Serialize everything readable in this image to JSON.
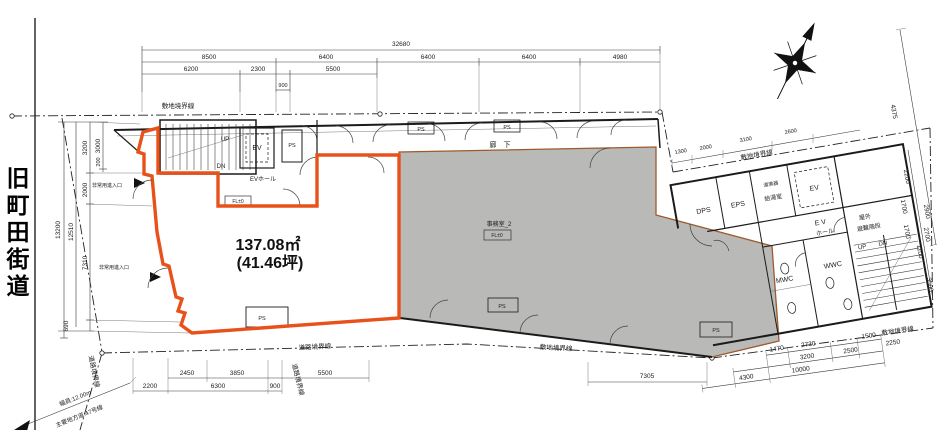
{
  "road": {
    "name": "旧町田街道",
    "width": "幅員:12.00m",
    "route": "主要地方道:47号線"
  },
  "area": {
    "size_sqm": "137.08㎡",
    "size_tsubo": "(41.46坪)"
  },
  "labels": {
    "site_boundary": "敷地境界線",
    "road_boundary": "道路境界線",
    "corridor": "廊　下",
    "emergency": "非常用進入口",
    "ev": "EV",
    "ev_sp": "E V",
    "hall": "ホール",
    "ev_hall": "EVホール",
    "ps": "PS",
    "dps": "DPS",
    "eps": "EPS",
    "kitchen": "給湯室",
    "water_heater": "湯沸器",
    "mwc": "MWC",
    "wwc": "WWC",
    "up": "UP",
    "dn": "DN",
    "outdoor": "屋外",
    "escape_stair": "避難階段",
    "office2": "事務室_2",
    "fl": "FL±0"
  },
  "dims": {
    "t32680": "32680",
    "t8500": "8500",
    "t6400": "6400",
    "t4980": "4980",
    "t6200": "6200",
    "t2300": "2300",
    "t5500": "5500",
    "t900": "900",
    "l3200": "3200",
    "l3000": "3000",
    "l200": "200",
    "l2000": "2000",
    "l13200": "13200",
    "l12510": "12510",
    "l7310": "7310",
    "l690": "690",
    "b2200": "2200",
    "b2450": "2450",
    "b3850": "3850",
    "b6300": "6300",
    "b900": "900",
    "b5500": "5500",
    "b7305": "7305",
    "br1470": "1470",
    "br2730": "2730",
    "br1500": "1500",
    "br3200": "3200",
    "br2500": "2500",
    "br2250": "2250",
    "br4300": "4300",
    "br10000": "10000",
    "r4375": "4375",
    "r2200": "2200",
    "r1700": "1700",
    "r2900": "2900",
    "r1100": "1100",
    "r2700": "2700",
    "r3500": "3500",
    "tr1300": "1300",
    "tr2000": "2000",
    "tr3100": "3100",
    "tr2600": "2600"
  },
  "colors": {
    "unit_outline": "#e8521a",
    "office_fill": "#b9b9b7",
    "office_border": "#9c5a2e"
  }
}
